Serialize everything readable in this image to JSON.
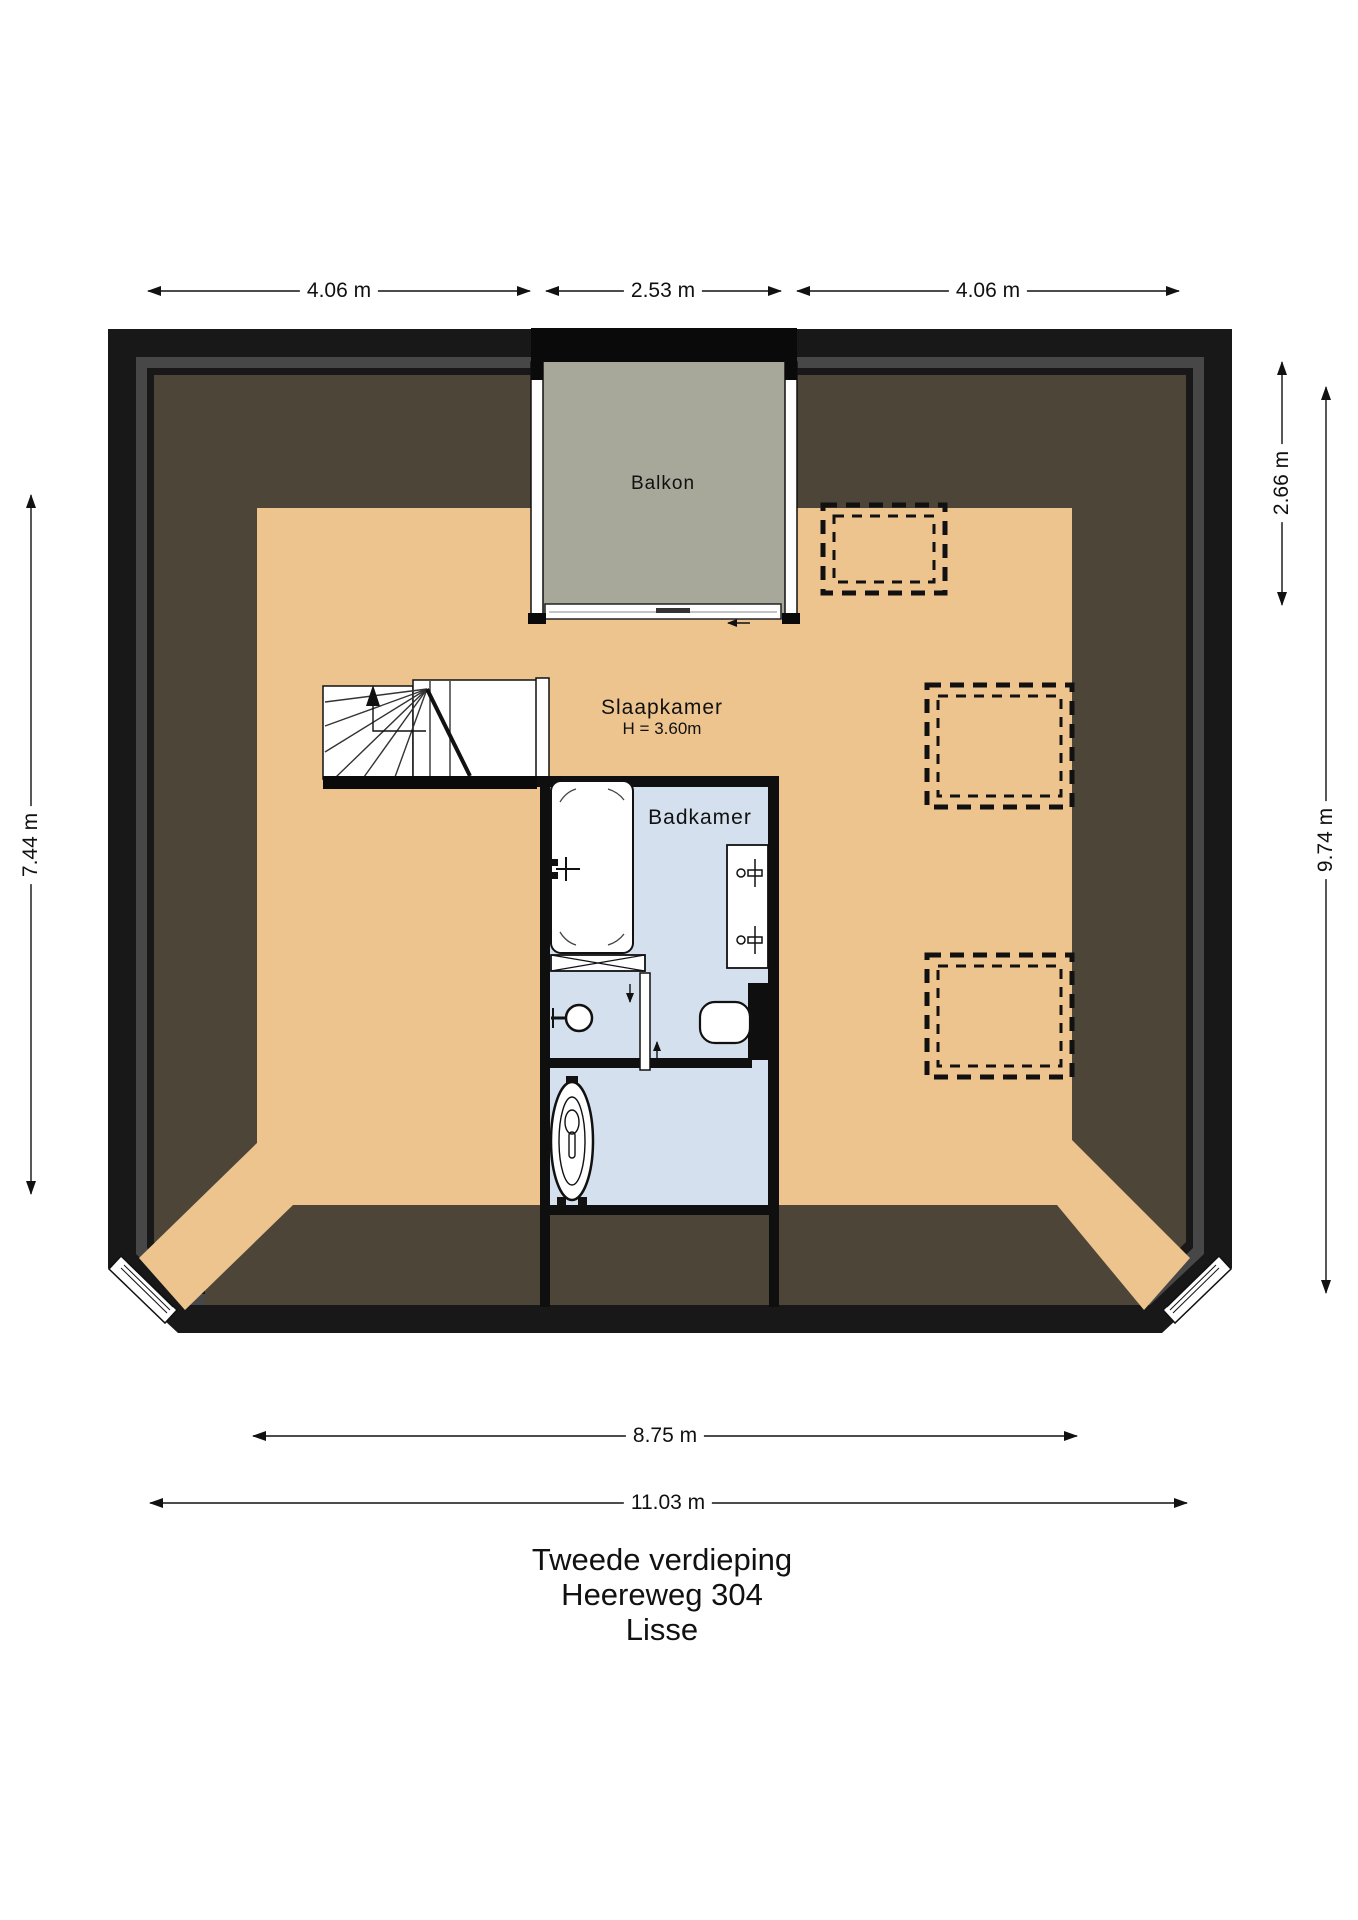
{
  "meta": {
    "floor": "Tweede verdieping",
    "address": "Heereweg 304",
    "city": "Lisse"
  },
  "rooms": {
    "bedroom": {
      "label": "Slaapkamer",
      "height_label": "H = 3.60m"
    },
    "bathroom": {
      "label": "Badkamer"
    },
    "balcony": {
      "label": "Balkon"
    }
  },
  "dimensions": {
    "top_left": "4.06 m",
    "top_middle": "2.53 m",
    "top_right": "4.06 m",
    "left": "7.44 m",
    "right_inner": "2.66 m",
    "right_outer": "9.74 m",
    "bottom_inner": "8.75 m",
    "bottom_outer": "11.03 m"
  },
  "colors": {
    "wall_black": "#181818",
    "lining_gray": "#474747",
    "roof_zone_brown": "#4e4539",
    "floor_tan": "#edc48e",
    "balcony_gray": "#a7a89a",
    "bathroom_blue": "#d4e0ed",
    "fixture_white": "#ffffff"
  }
}
